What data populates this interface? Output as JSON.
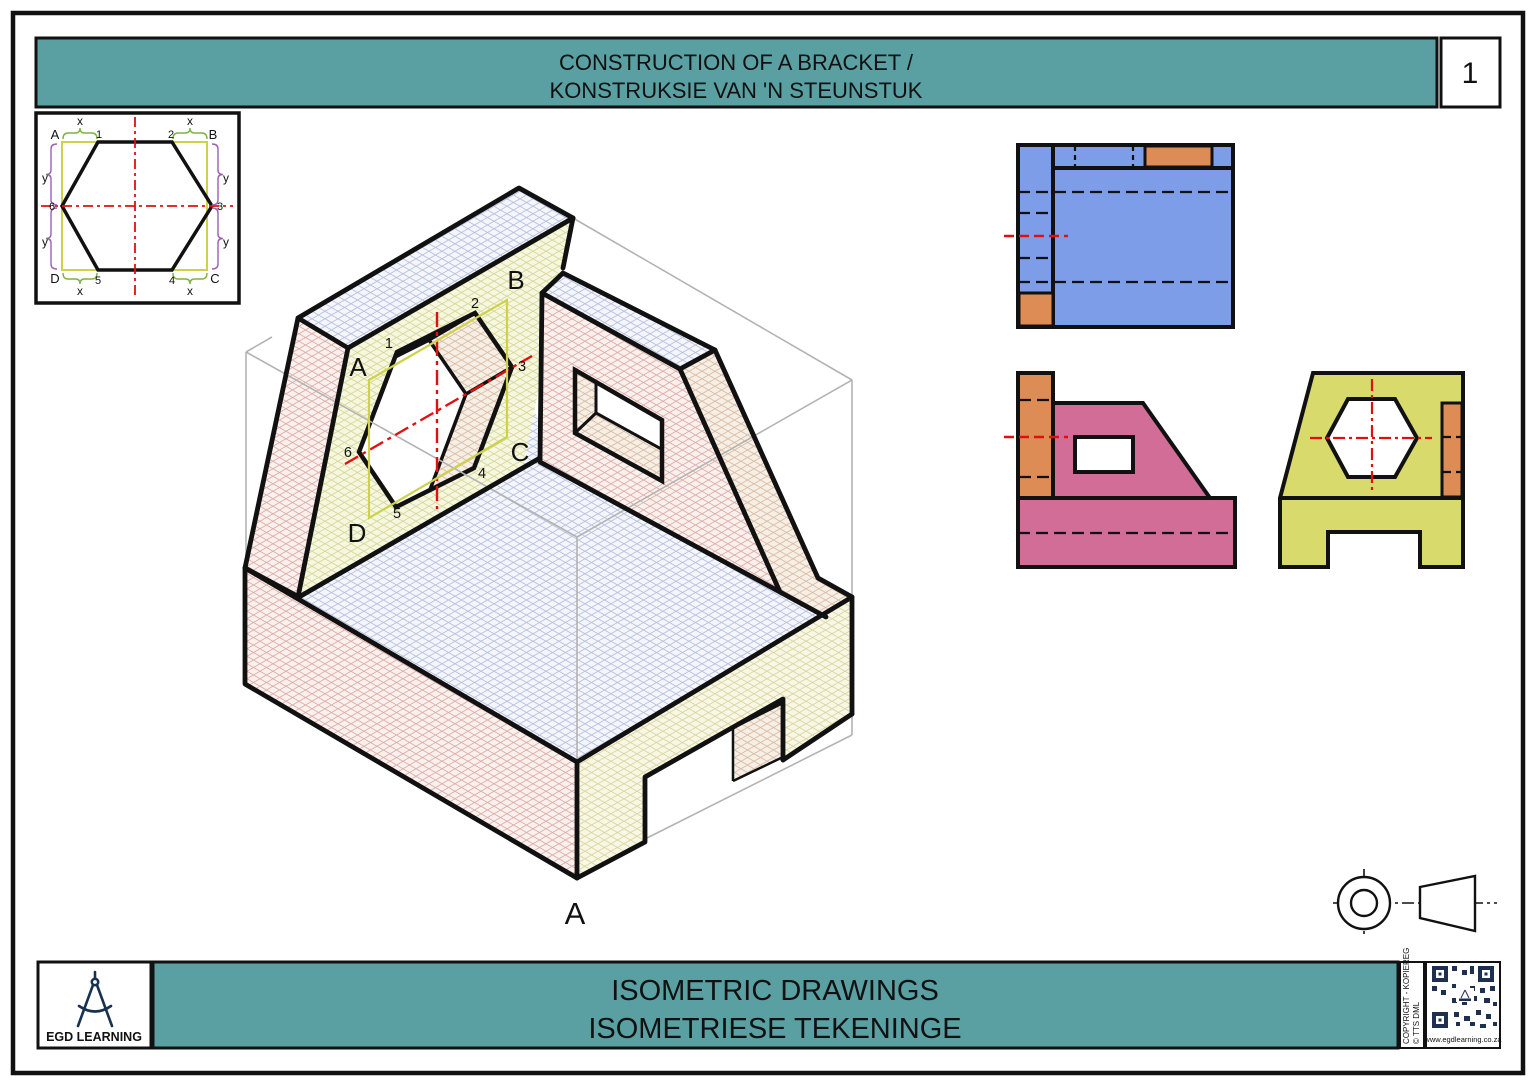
{
  "header": {
    "title_line1": "CONSTRUCTION OF A BRACKET /",
    "title_line2": "KONSTRUKSIE VAN 'N STEUNSTUK",
    "page_number": "1"
  },
  "construction_panel": {
    "corner_a": "A",
    "corner_b": "B",
    "corner_c": "C",
    "corner_d": "D",
    "n1": "1",
    "n2": "2",
    "n3": "3",
    "n4": "4",
    "n5": "5",
    "n6": "6",
    "x_label": "x",
    "y_label": "y"
  },
  "isometric": {
    "face_a": "A",
    "face_b": "B",
    "face_c": "C",
    "face_d": "D",
    "n1": "1",
    "n2": "2",
    "n3": "3",
    "n4": "4",
    "n5": "5",
    "n6": "6",
    "view_label": "A"
  },
  "footer": {
    "banner_line1": "ISOMETRIC DRAWINGS",
    "banner_line2": "ISOMETRIESE TEKENINGE",
    "logo_text": "EGD LEARNING",
    "copyright_line1": "COPYRIGHT - KOPIEREG",
    "copyright_line2": "© TTS DML",
    "website": "www.egdlearning.co.za"
  },
  "colors": {
    "banner_teal": "#5a9fa2",
    "top_view_blue": "#7e9de8",
    "front_view_pink": "#d16d97",
    "side_view_yellow": "#d8da6b",
    "accent_orange": "#de8c55",
    "centerline_red": "#e01010",
    "construction_yellow": "#cdd24a",
    "dim_green": "#7cb342",
    "dim_purple": "#9c5fb5",
    "logo_navy": "#16324f",
    "construction_gray": "#b3b3b3"
  }
}
